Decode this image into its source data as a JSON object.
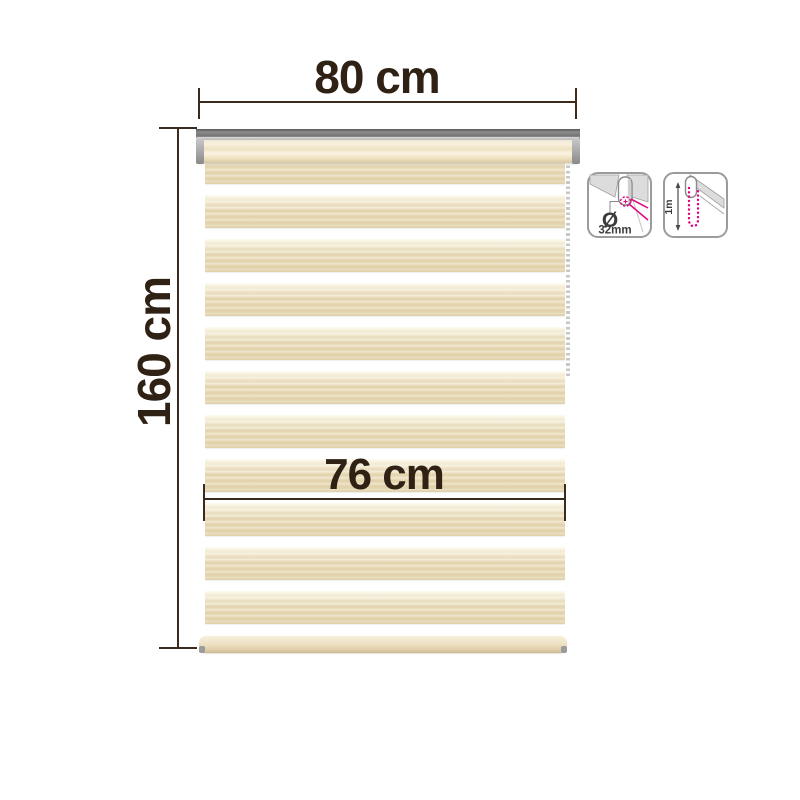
{
  "canvas": {
    "background": "#ffffff"
  },
  "dimension_labels": {
    "width": "80 cm",
    "height": "160 cm",
    "fabric_width": "76 cm"
  },
  "spec_badges": {
    "tube_diameter": {
      "symbol": "Ø",
      "value": "32mm"
    },
    "chain_drop": {
      "value": "1m"
    }
  },
  "blind": {
    "stripe_count": 11,
    "first_stripe_top": 151,
    "stripe_period": 44,
    "stripe_height": 33,
    "colors": {
      "stripe_base": "#e9dcba",
      "stripe_highlight": "#f9f3e3",
      "gap_white": "#ffffff",
      "rail_dark": "#747474",
      "rail_silver": "#d2d2d2",
      "roll_cream": "#f3e8cf",
      "bottom_bar": "#ecdfbe",
      "chain_beads": "#c7c7c7",
      "accent_magenta": "#e5007d",
      "annotation_dark": "#3c2b1d",
      "label_text": "#2f2114"
    }
  }
}
